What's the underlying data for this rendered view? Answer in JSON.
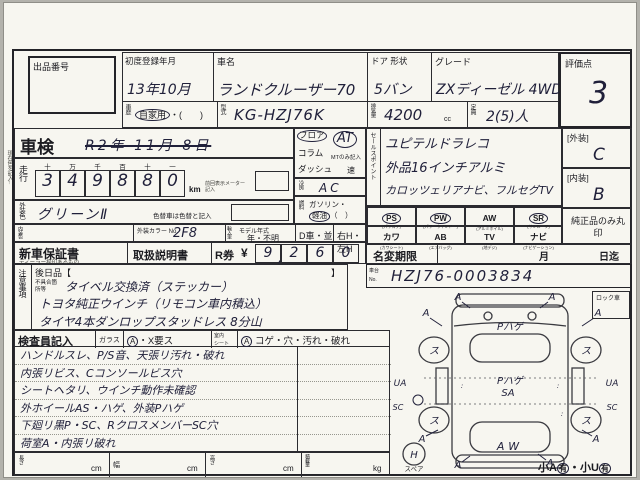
{
  "margin_note": "現在色を記入↑",
  "header": {
    "lot_label": "出品番号",
    "reg_label": "初度登録年月",
    "reg_value": "13年10月",
    "name_label": "車名",
    "name_value": "ランドクルーザー70",
    "door_label": "ドア 形状",
    "door_value": "5バン",
    "grade_label": "グレード",
    "grade_value": "ZXディーゼル 4WD",
    "score_label": "評価点",
    "score_value": "3"
  },
  "header2": {
    "history_label": "車歴",
    "history_value": "自家用",
    "history_paren": "・(　　)",
    "model_label": "型式",
    "model_value": "KG-HZJ76K",
    "disp_label": "排気量",
    "disp_value": "4200",
    "disp_unit": "cc",
    "cap_label": "定員",
    "cap_value": "2(5)人"
  },
  "shaken": {
    "label": "車検",
    "date": "R2年 11月 8日"
  },
  "mileage": {
    "label": "走行",
    "headers": [
      "十",
      "万",
      "千",
      "百",
      "十",
      "一"
    ],
    "digits": [
      "3",
      "4",
      "9",
      "8",
      "8",
      "0"
    ],
    "unit": "km",
    "unit_note": "前回表示メーター記入"
  },
  "ext_color": {
    "label": "外装色",
    "value": "グリーンⅡ",
    "note": "色替車は色替と記入"
  },
  "int_color": {
    "label": "内装色",
    "color_no_label": "外装カラー No.",
    "color_no_value": "2F8",
    "import_label": "輸入車",
    "year_label": "モデル年式",
    "year_value": "年・不明",
    "d_car": "D車・並",
    "handle": "右H・左H"
  },
  "warranty": {
    "label": "新車保証書",
    "sub": "ディーラー捺印あるもの",
    "manual": "取扱説明書",
    "ticket": "R券",
    "yen": "¥",
    "digits": [
      "9",
      "2",
      "6",
      "0"
    ],
    "comma": ","
  },
  "notice": {
    "label": "注意事項",
    "later": "後日品【",
    "later_close": "】",
    "defect_label": "不具合箇所等",
    "lines": [
      "タイベル交換済（ステッカー）",
      "トヨタ純正ウインチ（リモコン車内積込）",
      "タイヤ4本ダンロップスタッドレス 8分山"
    ]
  },
  "shift": {
    "opt1": "フロア",
    "opt2": "コラム",
    "opt3": "ダッシュ",
    "selected": "AT",
    "mt_note": "MTのみ記入",
    "speed": "速"
  },
  "cooling": {
    "label": "冷房",
    "value": "AC"
  },
  "fuel": {
    "label": "燃料",
    "gas": "ガソリン・",
    "diesel": "軽油",
    "paren": "（　）"
  },
  "sales": {
    "label": "セールスポイント",
    "lines": [
      "ユピテルドラレコ",
      "外品16インチアルミ",
      "カロッツェリアナビ、フルセグTV"
    ]
  },
  "equipment": {
    "cells": [
      {
        "code": "PS",
        "sub": "(パワステ)"
      },
      {
        "code": "PW",
        "sub": "(パワーウインドー)"
      },
      {
        "code": "AW",
        "sub": "(アルミホイル)"
      },
      {
        "code": "SR",
        "sub": "(サンルーフ)"
      },
      {
        "code": "カワ",
        "sub": "(カワシート)"
      },
      {
        "code": "AB",
        "sub": "(エアバッグ)"
      },
      {
        "code": "TV",
        "sub": "(地デジ)"
      },
      {
        "code": "ナビ",
        "sub": "(ナビゲーション)"
      }
    ],
    "genuine_note": "純正品のみ丸印"
  },
  "ratings": {
    "ext_label": "[外装]",
    "ext_value": "C",
    "int_label": "[内装]",
    "int_value": "B"
  },
  "name_change": {
    "label": "名変期限",
    "month": "月",
    "until": "日迄"
  },
  "chassis": {
    "label1": "車台",
    "label2": "No.",
    "value": "HZJ76-0003834"
  },
  "inspector": {
    "title": "検査員記入",
    "glass_label": "ガラス",
    "glass_mark": "A",
    "glass_text": "・X要ス",
    "seat_label1": "室内",
    "seat_label2": "シート",
    "seat_mark": "A",
    "seat_text": "コゲ・穴・汚れ・破れ",
    "notes": [
      "ハンドルスレ、P/S音、天張リ汚れ・破れ",
      "内張リビス、Cコンソールビス穴",
      "シートヘタリ、ウインチ動作未確認",
      "外ホイールAS・ハゲ、外装Pハゲ",
      "下廻リ黒P・SC、RクロスメンバーSC穴",
      "荷室A・内張リ破れ"
    ]
  },
  "dimensions": {
    "length_label": "長さ",
    "width_label": "幅",
    "height_label": "高さ",
    "load_label": "積載量",
    "cm": "cm",
    "kg": "kg"
  },
  "diagram": {
    "lock_label": "ロック車",
    "hood_note": "Pハゲ",
    "center_note1": "Pハゲ",
    "center_note2": "SA",
    "rear_note": "AW",
    "wheel_mark": "ス",
    "ua_left": "UA",
    "sc_left": "SC",
    "ua_right": "UA",
    "sc_right": "SC",
    "a_mark": "A",
    "spare_mark": "H",
    "spare_label": "スペア",
    "hail_prefix": "小A",
    "hail_mark1": "有",
    "hail_mid": "・小U",
    "hail_mark2": "有"
  }
}
